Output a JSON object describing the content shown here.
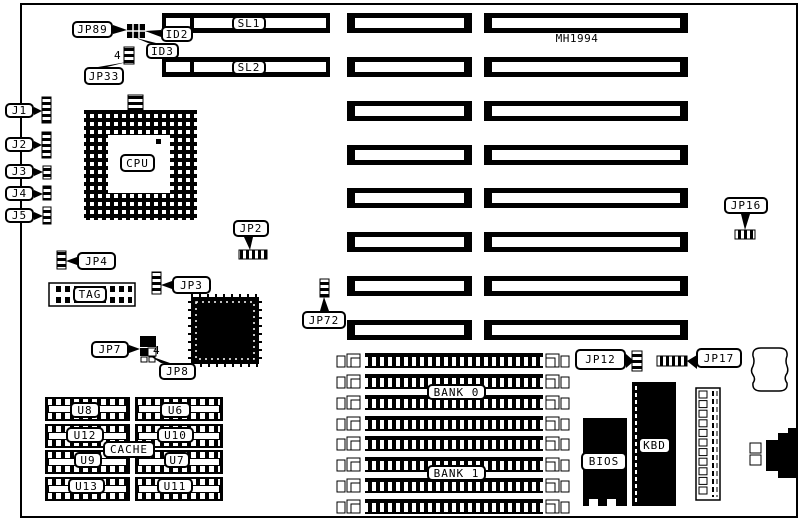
{
  "diagram": {
    "board_id": "MH1994",
    "colors": {
      "ink": "#000000",
      "paper": "#ffffff"
    },
    "labels": {
      "jp89": "JP89",
      "id2": "ID2",
      "id3": "ID3",
      "jp33": "JP33",
      "pin4_top": "4",
      "j1": "J1",
      "j2": "J2",
      "j3": "J3",
      "j4": "J4",
      "j5": "J5",
      "sl1": "SL1",
      "sl2": "SL2",
      "mh1994": "MH1994",
      "cpu": "CPU",
      "jp2": "JP2",
      "jp4": "JP4",
      "tag": "TAG",
      "jp3": "JP3",
      "jp72": "JP72",
      "jp16": "JP16",
      "jp7": "JP7",
      "pin4_mid": "4",
      "jp8": "JP8",
      "u8": "U8",
      "u6": "U6",
      "u12": "U12",
      "u10": "U10",
      "cache": "CACHE",
      "u9": "U9",
      "u7": "U7",
      "u13": "U13",
      "u11": "U11",
      "bank0": "BANK 0",
      "bank1": "BANK 1",
      "jp12": "JP12",
      "jp17": "JP17",
      "bios": "BIOS",
      "kbd": "KBD"
    }
  }
}
